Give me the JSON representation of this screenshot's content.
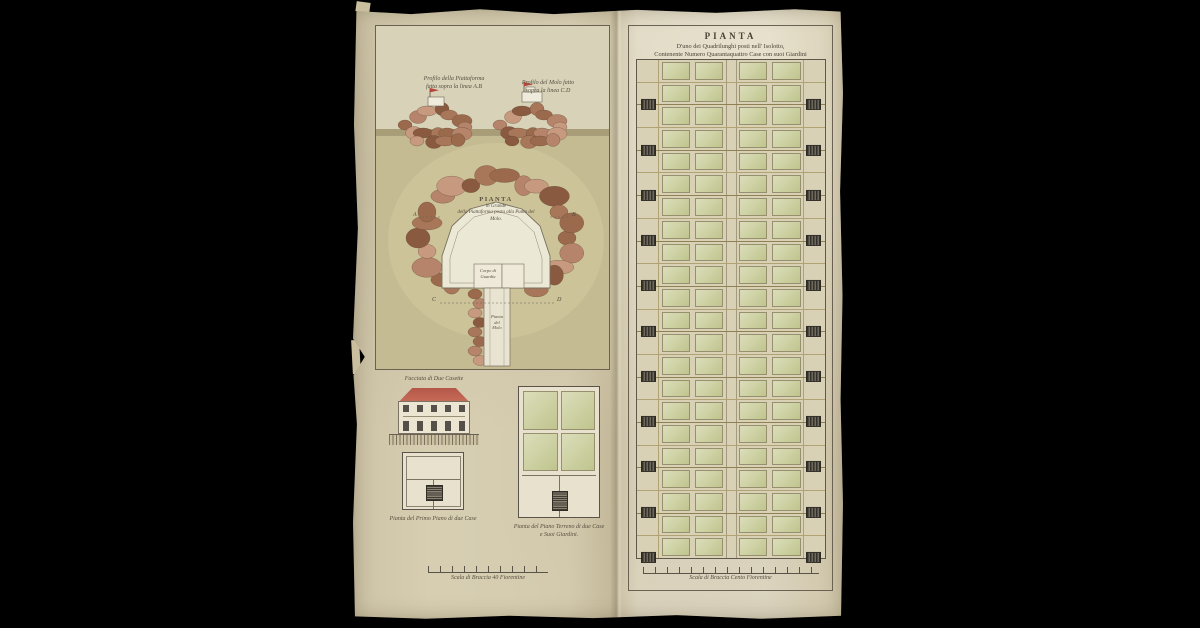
{
  "colors": {
    "background": "#000000",
    "paper": "#d7ceb2",
    "ink": "#4a4337",
    "frame_line": "#6b6152",
    "ground_wash": "#c5bb92",
    "sky_wash": "#d8d2b9",
    "rock_dark": "#8a5a40",
    "rock_light": "#c79a80",
    "platform_white": "#ece8d6",
    "garden_green": "#cfd3a6",
    "stair_dark": "#34312a",
    "roof_red": "#bf5f4d",
    "grid_olive": "#b0a273"
  },
  "left_panel": {
    "profile_left_caption_line1": "Profilo della Piattaforma",
    "profile_left_caption_line2": "fatta sopra la linea A.B",
    "profile_right_caption_line1": "Profilo del Molo fatto",
    "profile_right_caption_line2": "sopra la linea C.D",
    "fort_plan": {
      "title_line1": "PIANTA",
      "title_line2": "in Grande",
      "title_line3": "della Piattaforma posta alla Punta del",
      "title_line4": "Molo.",
      "guard_room_line1": "Corpo di",
      "guard_room_line2": "Guardia",
      "pier_label_line1": "Pianta",
      "pier_label_line2": "del",
      "pier_label_line3": "Molo",
      "letter_a": "A",
      "letter_b": "B",
      "letter_c": "C",
      "letter_d": "D"
    },
    "facade_caption": "Facciata di Due Casette",
    "plan_first_floor_caption": "Pianta del Primo Piano di due Case",
    "plan_ground_floor_caption_line1": "Pianta del Piano Terreno di due Case",
    "plan_ground_floor_caption_line2": "e Suoi Giardini.",
    "scale_caption": "Scala di Braccia 40 Fiorentine"
  },
  "right_panel": {
    "title": "PIANTA",
    "subtitle_line1": "D'uno dei Quadrilunghi posti nell' Isolotto,",
    "subtitle_line2": "Contenente Numero Quarantaquattro Case con suoi Giardini",
    "grid": {
      "rows": 22,
      "cols": 4,
      "stair_interval": 2,
      "stairs_per_side": 11
    },
    "scale_caption": "Scala di Braccia Cento Fiorentine"
  }
}
